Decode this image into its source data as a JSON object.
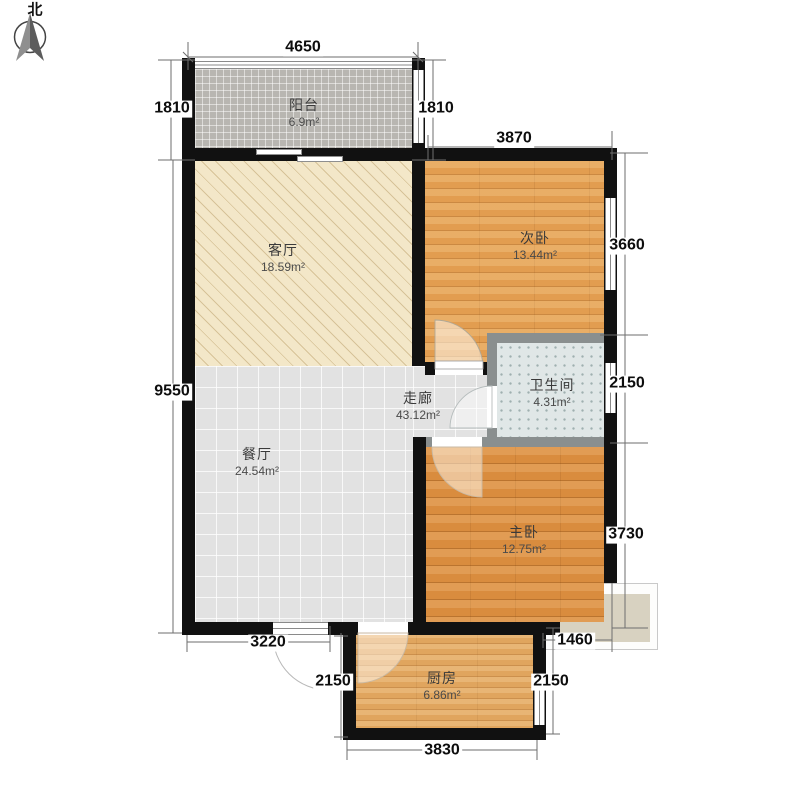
{
  "compass": {
    "label": "北"
  },
  "rooms": {
    "balcony": {
      "name": "阳台",
      "area": "6.9m²"
    },
    "living": {
      "name": "客厅",
      "area": "18.59m²"
    },
    "bedroom2": {
      "name": "次卧",
      "area": "13.44m²"
    },
    "bathroom": {
      "name": "卫生间",
      "area": "4.31m²"
    },
    "corridor": {
      "name": "走廊",
      "area": "43.12m²"
    },
    "dining": {
      "name": "餐厅",
      "area": "24.54m²"
    },
    "bedroom1": {
      "name": "主卧",
      "area": "12.75m²"
    },
    "kitchen": {
      "name": "厨房",
      "area": "6.86m²"
    }
  },
  "dimensions": {
    "top": "4650",
    "balcony_left": "1810",
    "balcony_right": "1810",
    "bedroom2_top": "3870",
    "bedroom2_right": "3660",
    "bathroom_right": "2150",
    "bedroom1_right": "3730",
    "left": "9550",
    "bottom_left": "3220",
    "entrance": "2150",
    "kitchen_right": "2150",
    "platform": "1460",
    "kitchen_bottom": "3830"
  },
  "palette": {
    "wall": "#111111",
    "bath_wall": "#8a8f8f",
    "bedroom2_floor": "#e29d50",
    "master_floor": "#d98c3e",
    "kitchen_floor": "#e0a55e",
    "living_floor": "#f3e7c8",
    "tile_floor": "#e2e2e2",
    "balcony_floor": "#b8b6b1",
    "bath_floor": "#e0e7e7",
    "platform": "#d8d2c1"
  }
}
